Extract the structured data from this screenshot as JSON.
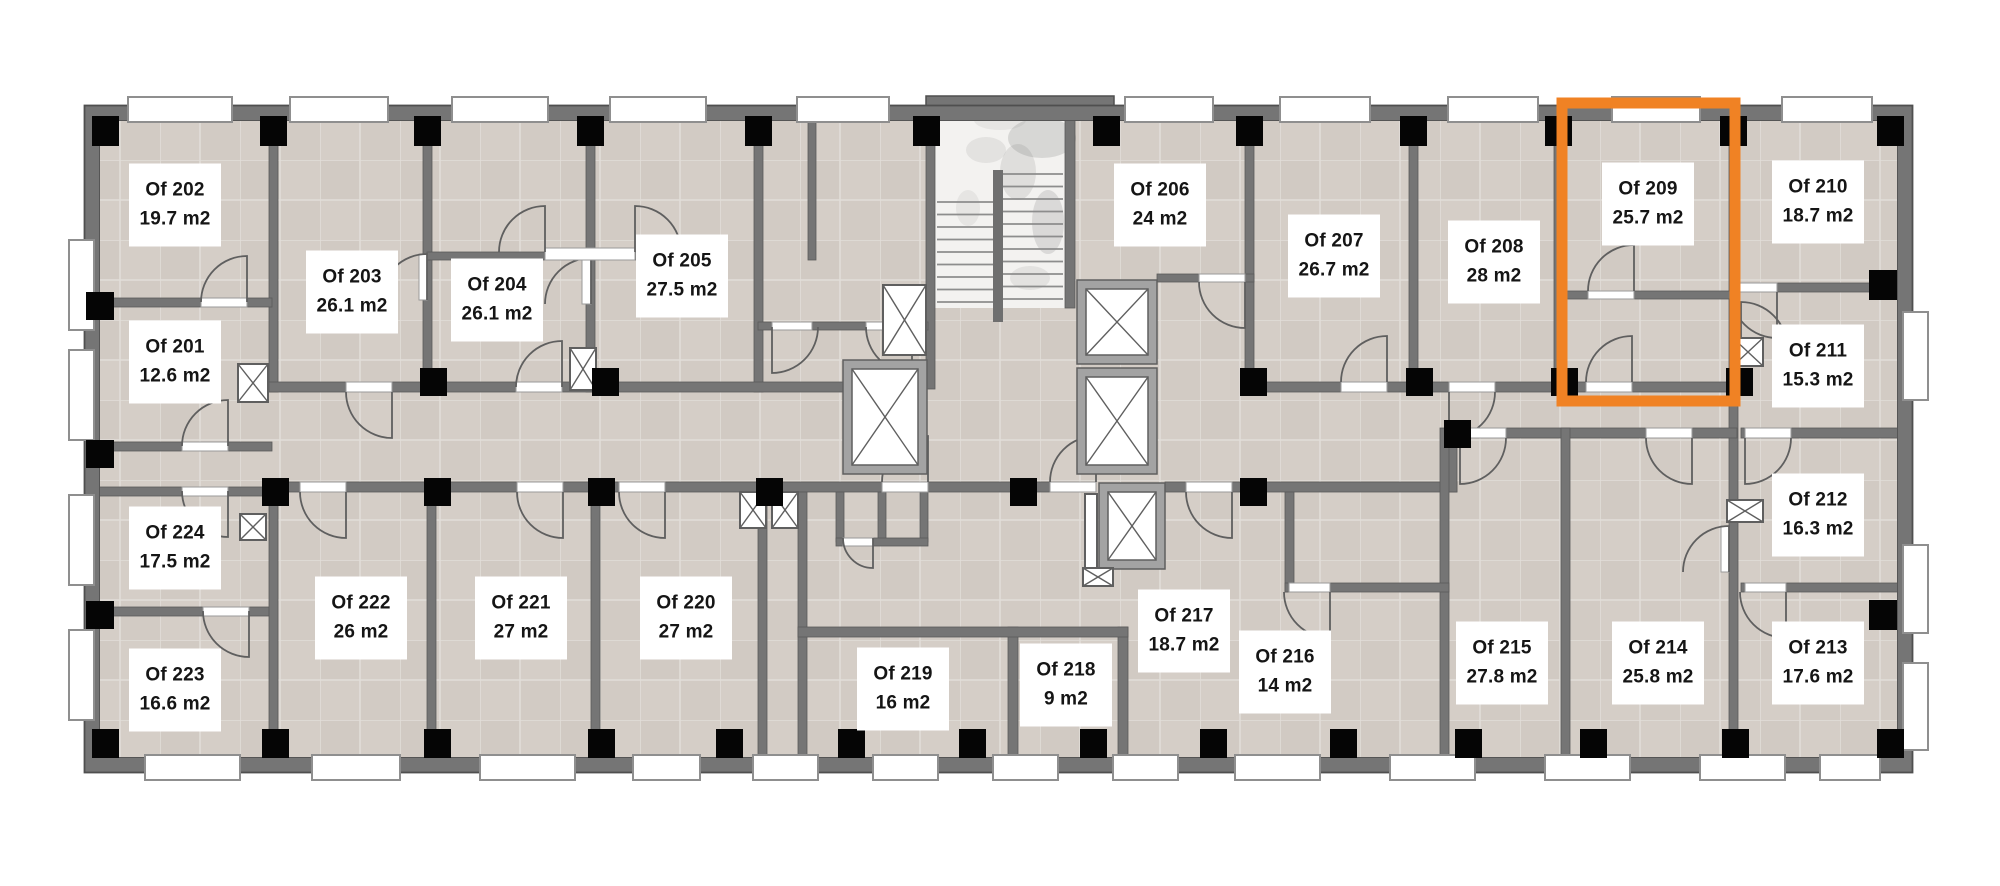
{
  "floor_plan": {
    "title": "Office floor plan — level 2",
    "unit": "m2",
    "highlight_color": "#F08224",
    "highlighted_room": "Of 209",
    "rooms": [
      {
        "id": "Of 201",
        "area": "12.6 m2",
        "cx": 175,
        "cy": 362,
        "highlighted": false
      },
      {
        "id": "Of 202",
        "area": "19.7 m2",
        "cx": 175,
        "cy": 205,
        "highlighted": false
      },
      {
        "id": "Of 203",
        "area": "26.1 m2",
        "cx": 352,
        "cy": 292,
        "highlighted": false
      },
      {
        "id": "Of 204",
        "area": "26.1 m2",
        "cx": 497,
        "cy": 300,
        "highlighted": false
      },
      {
        "id": "Of 205",
        "area": "27.5 m2",
        "cx": 682,
        "cy": 276,
        "highlighted": false
      },
      {
        "id": "Of 206",
        "area": "24 m2",
        "cx": 1160,
        "cy": 205,
        "highlighted": false
      },
      {
        "id": "Of 207",
        "area": "26.7 m2",
        "cx": 1334,
        "cy": 256,
        "highlighted": false
      },
      {
        "id": "Of 208",
        "area": "28 m2",
        "cx": 1494,
        "cy": 262,
        "highlighted": false
      },
      {
        "id": "Of 209",
        "area": "25.7 m2",
        "cx": 1648,
        "cy": 204,
        "highlighted": true
      },
      {
        "id": "Of 210",
        "area": "18.7 m2",
        "cx": 1818,
        "cy": 202,
        "highlighted": false
      },
      {
        "id": "Of 211",
        "area": "15.3 m2",
        "cx": 1818,
        "cy": 366,
        "highlighted": false
      },
      {
        "id": "Of 212",
        "area": "16.3 m2",
        "cx": 1818,
        "cy": 515,
        "highlighted": false
      },
      {
        "id": "Of 213",
        "area": "17.6 m2",
        "cx": 1818,
        "cy": 663,
        "highlighted": false
      },
      {
        "id": "Of 214",
        "area": "25.8 m2",
        "cx": 1658,
        "cy": 663,
        "highlighted": false
      },
      {
        "id": "Of 215",
        "area": "27.8 m2",
        "cx": 1502,
        "cy": 663,
        "highlighted": false
      },
      {
        "id": "Of 216",
        "area": "14 m2",
        "cx": 1285,
        "cy": 672,
        "highlighted": false
      },
      {
        "id": "Of 217",
        "area": "18.7 m2",
        "cx": 1184,
        "cy": 631,
        "highlighted": false
      },
      {
        "id": "Of 218",
        "area": "9 m2",
        "cx": 1066,
        "cy": 685,
        "highlighted": false
      },
      {
        "id": "Of 219",
        "area": "16 m2",
        "cx": 903,
        "cy": 689,
        "highlighted": false
      },
      {
        "id": "Of 220",
        "area": "27 m2",
        "cx": 686,
        "cy": 618,
        "highlighted": false
      },
      {
        "id": "Of 221",
        "area": "27 m2",
        "cx": 521,
        "cy": 618,
        "highlighted": false
      },
      {
        "id": "Of 222",
        "area": "26 m2",
        "cx": 361,
        "cy": 618,
        "highlighted": false
      },
      {
        "id": "Of 223",
        "area": "16.6 m2",
        "cx": 175,
        "cy": 690,
        "highlighted": false
      },
      {
        "id": "Of 224",
        "area": "17.5 m2",
        "cx": 175,
        "cy": 548,
        "highlighted": false
      }
    ]
  }
}
